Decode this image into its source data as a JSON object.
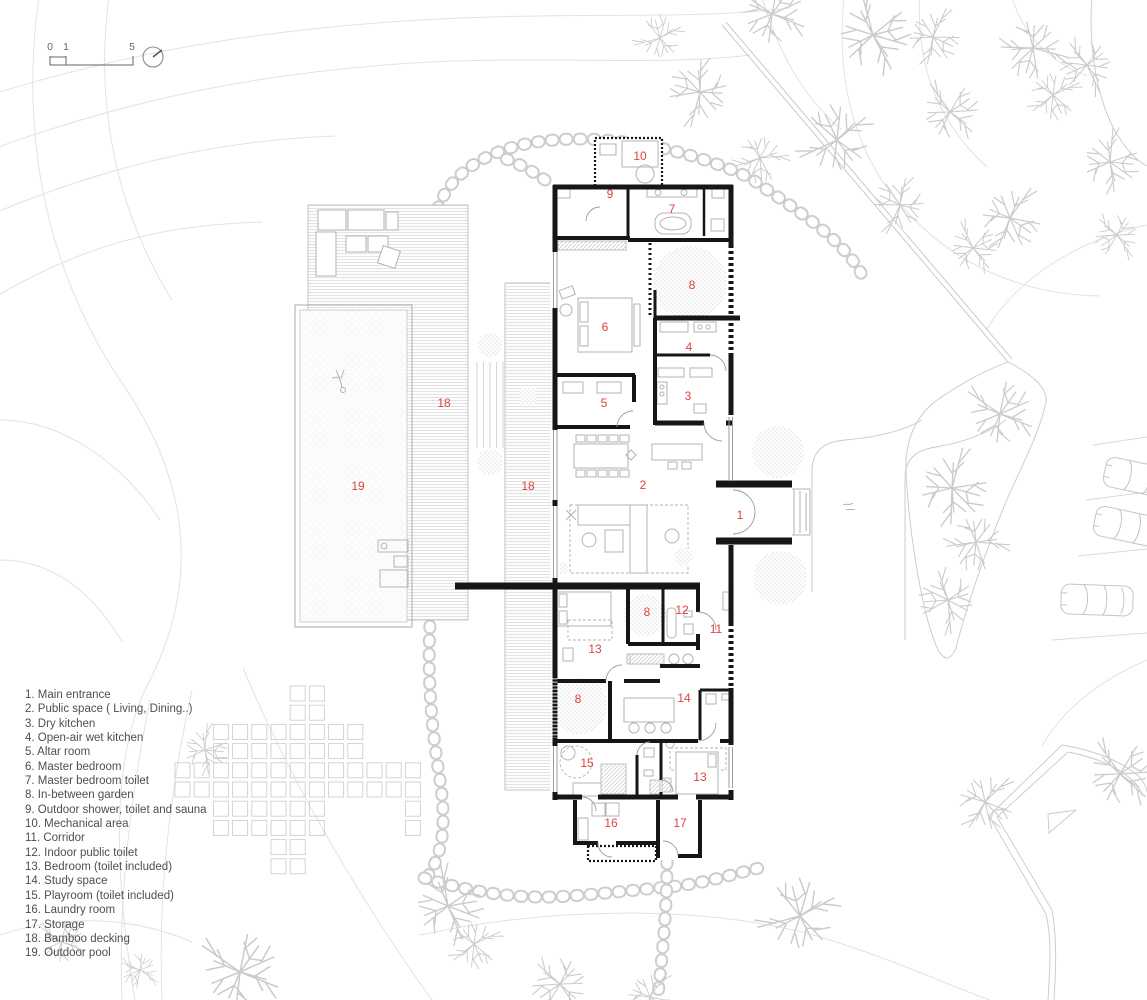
{
  "scale_bar": {
    "ticks": [
      "0",
      "1",
      "5"
    ]
  },
  "legend": {
    "items": [
      "1. Main entrance",
      "2. Public space ( Living, Dining..)",
      "3. Dry kitchen",
      "4. Open-air wet kitchen",
      "5. Altar room",
      "6. Master bedroom",
      "7. Master bedroom toilet",
      "8. In-between garden",
      "9. Outdoor shower, toilet and sauna",
      "10. Mechanical area",
      "11. Corridor",
      "12. Indoor public toilet",
      "13. Bedroom (toilet included)",
      "14. Study space",
      "15. Playroom (toilet included)",
      "16. Laundry room",
      "17. Storage",
      "18. Bamboo decking",
      "19. Outdoor pool"
    ]
  },
  "plan": {
    "room_labels": [
      {
        "text": "10",
        "room": "Mechanical area"
      },
      {
        "text": "9",
        "room": "Outdoor shower, toilet and sauna"
      },
      {
        "text": "7",
        "room": "Master bedroom toilet"
      },
      {
        "text": "8",
        "room": "In-between garden upper"
      },
      {
        "text": "6",
        "room": "Master bedroom"
      },
      {
        "text": "4",
        "room": "Open-air wet kitchen"
      },
      {
        "text": "3",
        "room": "Dry kitchen"
      },
      {
        "text": "5",
        "room": "Altar room"
      },
      {
        "text": "18",
        "room": "Bamboo decking west"
      },
      {
        "text": "2",
        "room": "Public space"
      },
      {
        "text": "19",
        "room": "Outdoor pool"
      },
      {
        "text": "18",
        "room": "Bamboo decking strip"
      },
      {
        "text": "1",
        "room": "Main entrance"
      },
      {
        "text": "8",
        "room": "In-between garden middle"
      },
      {
        "text": "12",
        "room": "Indoor public toilet"
      },
      {
        "text": "11",
        "room": "Corridor"
      },
      {
        "text": "13",
        "room": "Bedroom upper"
      },
      {
        "text": "8",
        "room": "In-between garden lower"
      },
      {
        "text": "14",
        "room": "Study space"
      },
      {
        "text": "15",
        "room": "Playroom"
      },
      {
        "text": "13",
        "room": "Bedroom lower"
      },
      {
        "text": "16",
        "room": "Laundry room"
      },
      {
        "text": "17",
        "room": "Storage"
      }
    ]
  },
  "colors": {
    "label_red": "#df4340",
    "wall_black": "#161616",
    "legend_text": "#4e4e4e",
    "furniture_gray": "#b3b3b3",
    "site_line": "#e2e2e2"
  }
}
